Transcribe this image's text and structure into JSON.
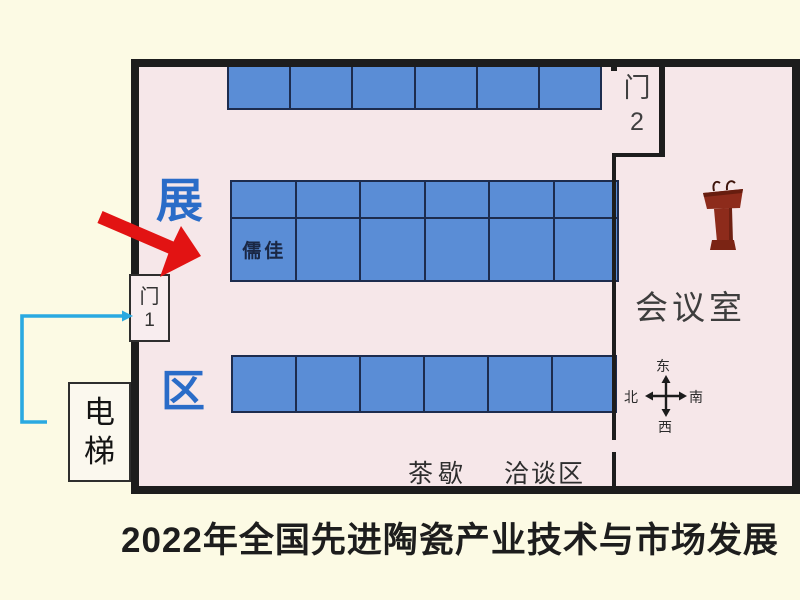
{
  "caption": "2022年全国先进陶瓷产业技术与市场发展",
  "floor_plan": {
    "area_label_top": "展",
    "area_label_bottom": "区",
    "door1": {
      "char": "门",
      "num": "1"
    },
    "door2": {
      "char": "门",
      "num": "2"
    },
    "elevator": {
      "char1": "电",
      "char2": "梯"
    },
    "meeting_room": "会议室",
    "tea_break": "茶歇",
    "negotiation_area": "洽谈区",
    "compass": {
      "up": "东",
      "down": "西",
      "left": "北",
      "right": "南"
    },
    "booth_blocks": {
      "top": {
        "rows": 1,
        "cols": 6
      },
      "middle": {
        "rows": 2,
        "cols": 6,
        "labeled_cell": {
          "row": 1,
          "col": 0,
          "label": "儒佳"
        }
      },
      "bottom": {
        "rows": 1,
        "cols": 6
      }
    },
    "icons": {
      "podium": "podium-with-microphones",
      "red_arrow": "booth-pointer",
      "cyan_arrow": "entrance-route"
    },
    "colors": {
      "background": "#fcfae4",
      "floor": "#f6e7e9",
      "wall": "#1d1d1d",
      "booth_blue": "#5a8dd6",
      "booth_border": "#1d2c4e",
      "blue_text": "#2a6cc8",
      "red_arrow": "#e21313",
      "cyan_arrow": "#2aa9e1",
      "podium_red": "#8d2b1b"
    }
  }
}
